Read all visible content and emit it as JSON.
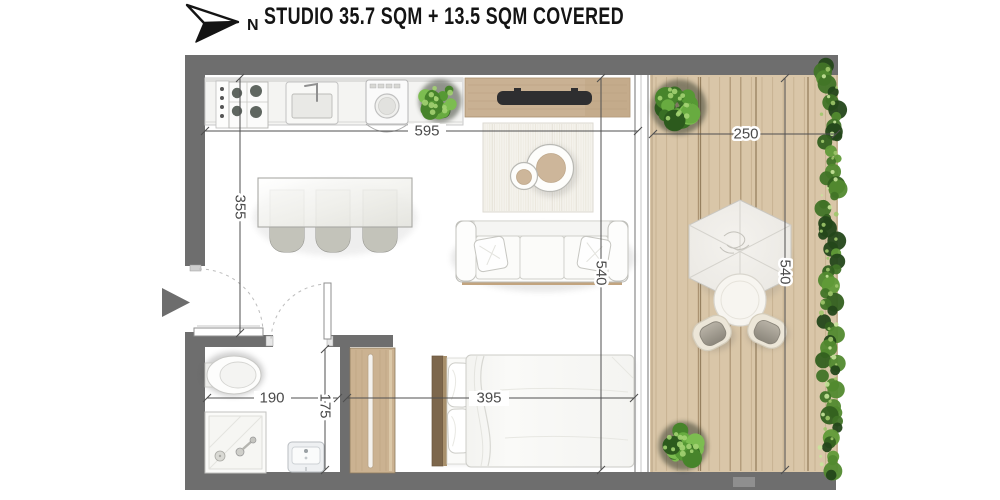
{
  "header": {
    "north_label": "N",
    "title": "STUDIO 35.7 SQM + 13.5 SQM COVERED"
  },
  "dimensions": {
    "interior_width": "595",
    "living_depth": "355",
    "interior_depth": "540",
    "terrace_width": "250",
    "terrace_depth": "540",
    "bathroom_width": "190",
    "bathroom_depth": "175",
    "bedroom_width": "395"
  },
  "colors": {
    "wall": "#6e6e6e",
    "deck_wood": "#d9c6a8",
    "furniture_wood": "#c9b193",
    "dark_wood": "#7d674c",
    "greenery": "#4e7f2d",
    "dimension_text": "#4a4a4a",
    "title_text": "#141414",
    "floor": "#ffffff"
  },
  "features": [
    "north-arrow",
    "kitchen-hob",
    "kitchen-sink",
    "washing-machine",
    "counter-plant",
    "tv-console",
    "television",
    "area-rug",
    "nesting-coffee-tables",
    "sofa",
    "dining-table",
    "dining-chairs",
    "double-bed",
    "wardrobe",
    "toilet",
    "shower",
    "washbasin",
    "entry-door",
    "bathroom-door",
    "entrance-arrow",
    "covered-terrace",
    "parasol",
    "outdoor-table",
    "outdoor-chairs",
    "planters",
    "hedge",
    "timber-decking"
  ]
}
